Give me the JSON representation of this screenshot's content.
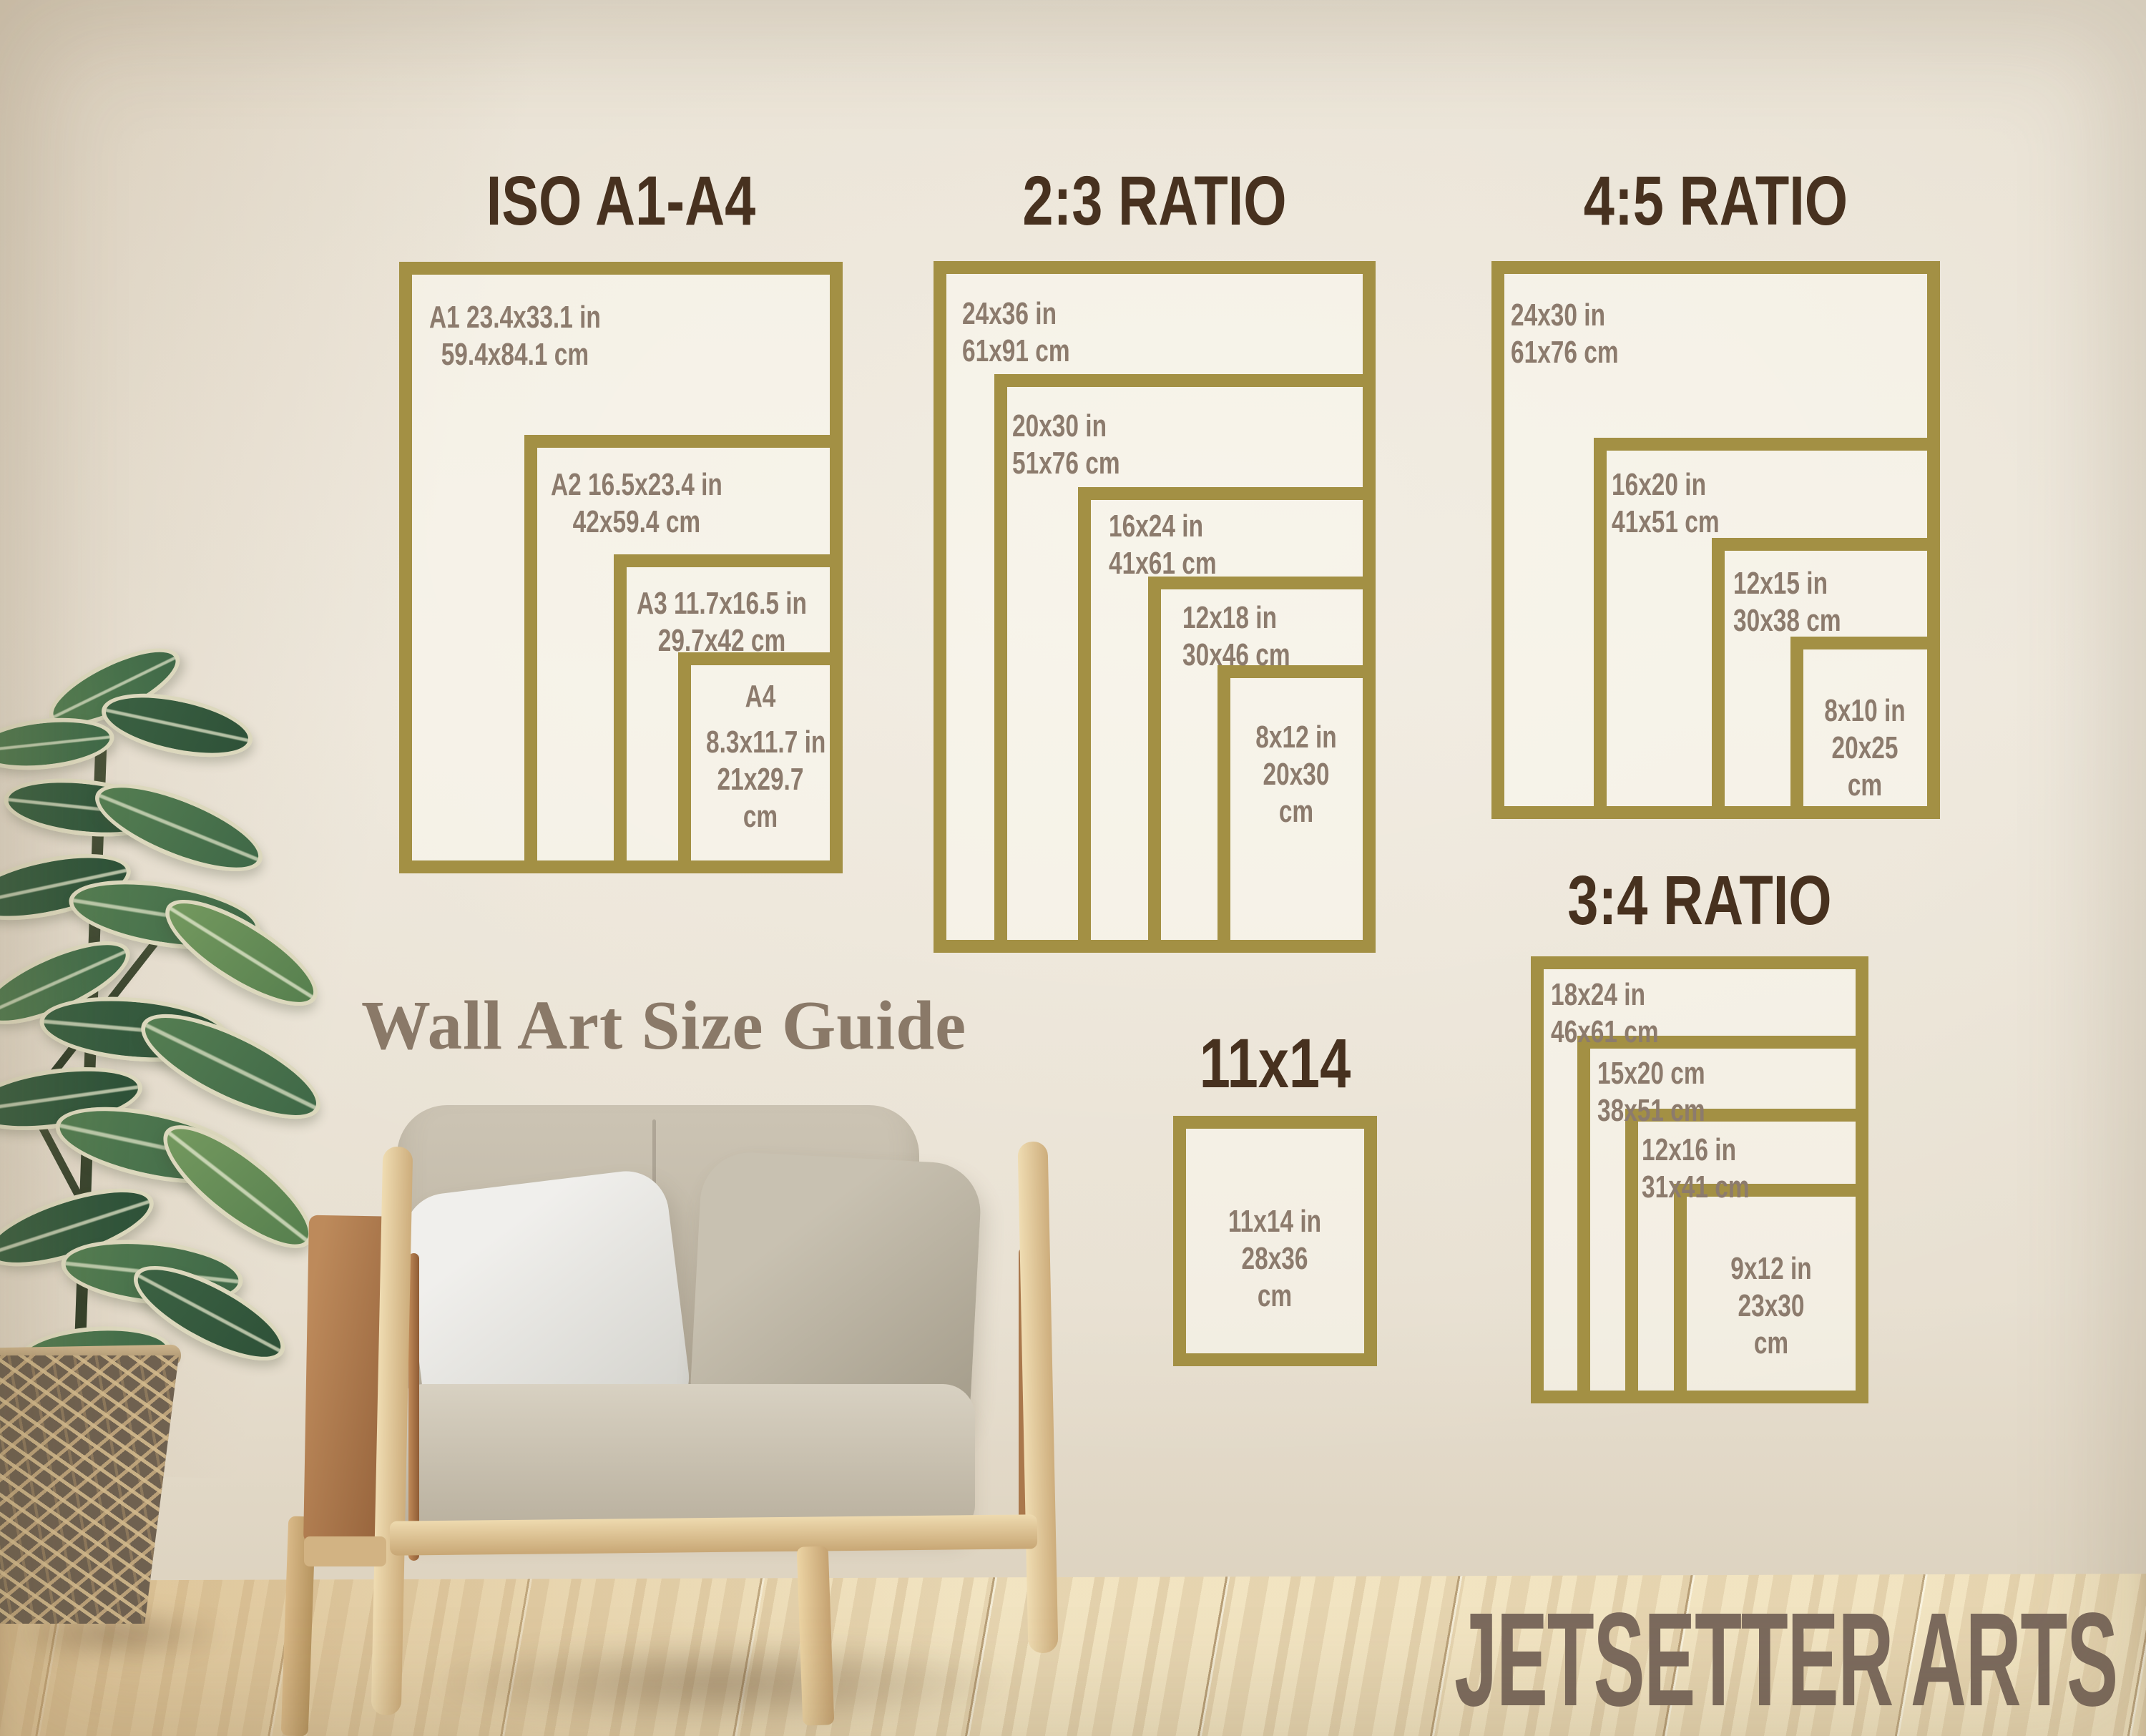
{
  "caption": "Wall Art Size Guide",
  "brand": "JETSETTER ARTS",
  "colors": {
    "frame_gold": "#a39044",
    "title_brown": "#47311f",
    "label_taupe": "#8c7b6d",
    "caption_color": "#8a7968",
    "brand_color": "#7b6a5d",
    "wall": "#e9e2d5",
    "floor_wood": "#eddcb6"
  },
  "sections": [
    {
      "id": "iso",
      "title": "ISO A1-A4",
      "frames": [
        {
          "name": "A1",
          "lines": [
            "A1 23.4x33.1 in",
            "59.4x84.1 cm"
          ]
        },
        {
          "name": "A2",
          "lines": [
            "A2 16.5x23.4 in",
            "42x59.4 cm"
          ]
        },
        {
          "name": "A3",
          "lines": [
            "A3 11.7x16.5 in",
            "29.7x42 cm"
          ]
        },
        {
          "name": "A4",
          "lines": [
            "A4",
            "8.3x11.7 in",
            "21x29.7",
            "cm"
          ]
        }
      ]
    },
    {
      "id": "ratio-2-3",
      "title": "2:3 RATIO",
      "frames": [
        {
          "name": "24x36",
          "lines": [
            "24x36 in",
            "61x91 cm"
          ]
        },
        {
          "name": "20x30",
          "lines": [
            "20x30 in",
            "51x76 cm"
          ]
        },
        {
          "name": "16x24",
          "lines": [
            "16x24 in",
            "41x61 cm"
          ]
        },
        {
          "name": "12x18",
          "lines": [
            "12x18 in",
            "30x46 cm"
          ]
        },
        {
          "name": "8x12",
          "lines": [
            "8x12 in",
            "20x30",
            "cm"
          ]
        }
      ]
    },
    {
      "id": "ratio-4-5",
      "title": "4:5 RATIO",
      "frames": [
        {
          "name": "24x30",
          "lines": [
            "24x30 in",
            "61x76 cm"
          ]
        },
        {
          "name": "16x20",
          "lines": [
            "16x20 in",
            "41x51 cm"
          ]
        },
        {
          "name": "12x15",
          "lines": [
            "12x15 in",
            "30x38 cm"
          ]
        },
        {
          "name": "8x10",
          "lines": [
            "8x10 in",
            "20x25",
            "cm"
          ]
        }
      ]
    },
    {
      "id": "ratio-3-4",
      "title": "3:4 RATIO",
      "frames": [
        {
          "name": "18x24",
          "lines": [
            "18x24 in",
            "46x61 cm"
          ]
        },
        {
          "name": "15x20",
          "lines": [
            "15x20 cm",
            "38x51 cm"
          ]
        },
        {
          "name": "12x16",
          "lines": [
            "12x16 in",
            "31x41 cm"
          ]
        },
        {
          "name": "9x12",
          "lines": [
            "9x12 in",
            "23x30",
            "cm"
          ]
        }
      ]
    },
    {
      "id": "size-11x14",
      "title": "11x14",
      "frames": [
        {
          "name": "11x14",
          "lines": [
            "11x14 in",
            "28x36",
            "cm"
          ]
        }
      ]
    }
  ]
}
